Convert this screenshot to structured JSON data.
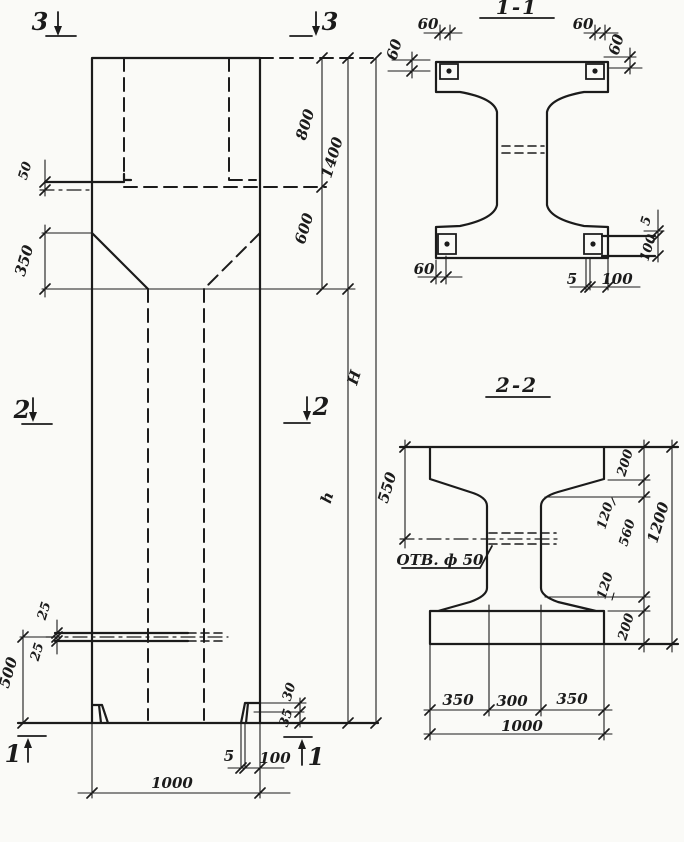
{
  "background": "#fafaf7",
  "ink": "#1b1b1b",
  "elevation": {
    "marks": {
      "top_left": "3",
      "top_right": "3",
      "mid_left": "2",
      "mid_right": "2",
      "bot_left": "1",
      "bot_right": "1"
    },
    "dims": {
      "ledge_50": "50",
      "taper_350": "350",
      "hole_25a": "25",
      "hole_25b": "25",
      "height_500": "500",
      "width_1000": "1000",
      "plate_5": "5",
      "plate_100": "100",
      "lip_30": "30",
      "lip_35": "35",
      "seg_800": "800",
      "seg_600": "600",
      "seg_1400": "1400",
      "shaft_h": "h",
      "total_H": "Н"
    }
  },
  "section11": {
    "title": "1-1",
    "dims": {
      "tl_60": "60",
      "tr_60": "60",
      "right_60": "60",
      "left_60": "60",
      "bl_60": "60",
      "bot_5": "5",
      "bot_100": "100",
      "side_5": "5",
      "side_100": "100"
    }
  },
  "section22": {
    "title": "2-2",
    "hole_label": "ОТВ. ф 50",
    "dims": {
      "d550": "550",
      "top_200": "200",
      "top_120": "120",
      "web_560": "560",
      "bot_120": "120",
      "bot_200": "200",
      "total_1200": "1200",
      "left_350": "350",
      "mid_300": "300",
      "right_350": "350",
      "total_1000": "1000"
    }
  }
}
